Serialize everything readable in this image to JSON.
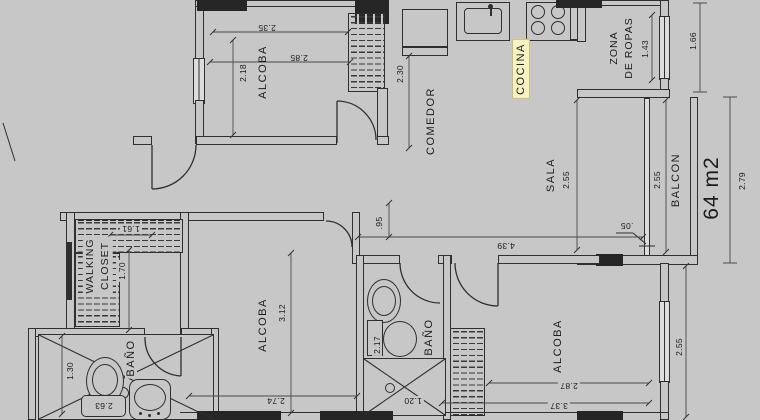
{
  "plan": {
    "area": "64 m2",
    "rooms": {
      "alcoba_top_left": "ALCOBA",
      "cocina": "COCINA",
      "comedor": "COMEDOR",
      "zona_line1": "ZONA",
      "zona_line2": "DE ROPAS",
      "sala": "SALA",
      "balcon": "BALCON",
      "walking_line1": "WALKING",
      "walking_line2": "CLOSET",
      "alcoba_center": "ALCOBA",
      "bano_center": "BAÑO",
      "alcoba_bottom_right": "ALCOBA",
      "bano_bottom_left": "BAÑO"
    },
    "dimensions": {
      "alcoba_tl_top": "2.35",
      "alcoba_tl_width": "2.85",
      "alcoba_tl_height": "2.18",
      "comedor_height": "2.30",
      "zona_width": "1.43",
      "zona_width_ext": "1.66",
      "sala_height": "2.55",
      "balcon_height": "2.55",
      "balcon_ext": "2.79",
      "glass_offset": ".05",
      "hall_offset": ".95",
      "sala_width": "4.39",
      "closet_width": "1.61",
      "closet_height": "1.70",
      "alcoba_center_height": "3.12",
      "alcoba_center_width": "2.74",
      "bano_center_height": "2.17",
      "bano_center_width": "1.20",
      "alcoba_br_width_inner": "2.87",
      "alcoba_br_width": "3.37",
      "alcoba_br_height": "2.55",
      "bano_bl_height": "1.30",
      "bano_bl_width": "2.63"
    },
    "fixtures": [
      "refrigerator",
      "kitchen-sink",
      "stove-4-burners",
      "washbasin",
      "toilet",
      "shower",
      "wardrobe-hatch",
      "mirror"
    ],
    "colors": {
      "background": "#c7c7c7",
      "linework": "#2f2f2f",
      "highlight_bg": "#f8f2c3",
      "highlight_border": "#c9bd7a"
    }
  }
}
